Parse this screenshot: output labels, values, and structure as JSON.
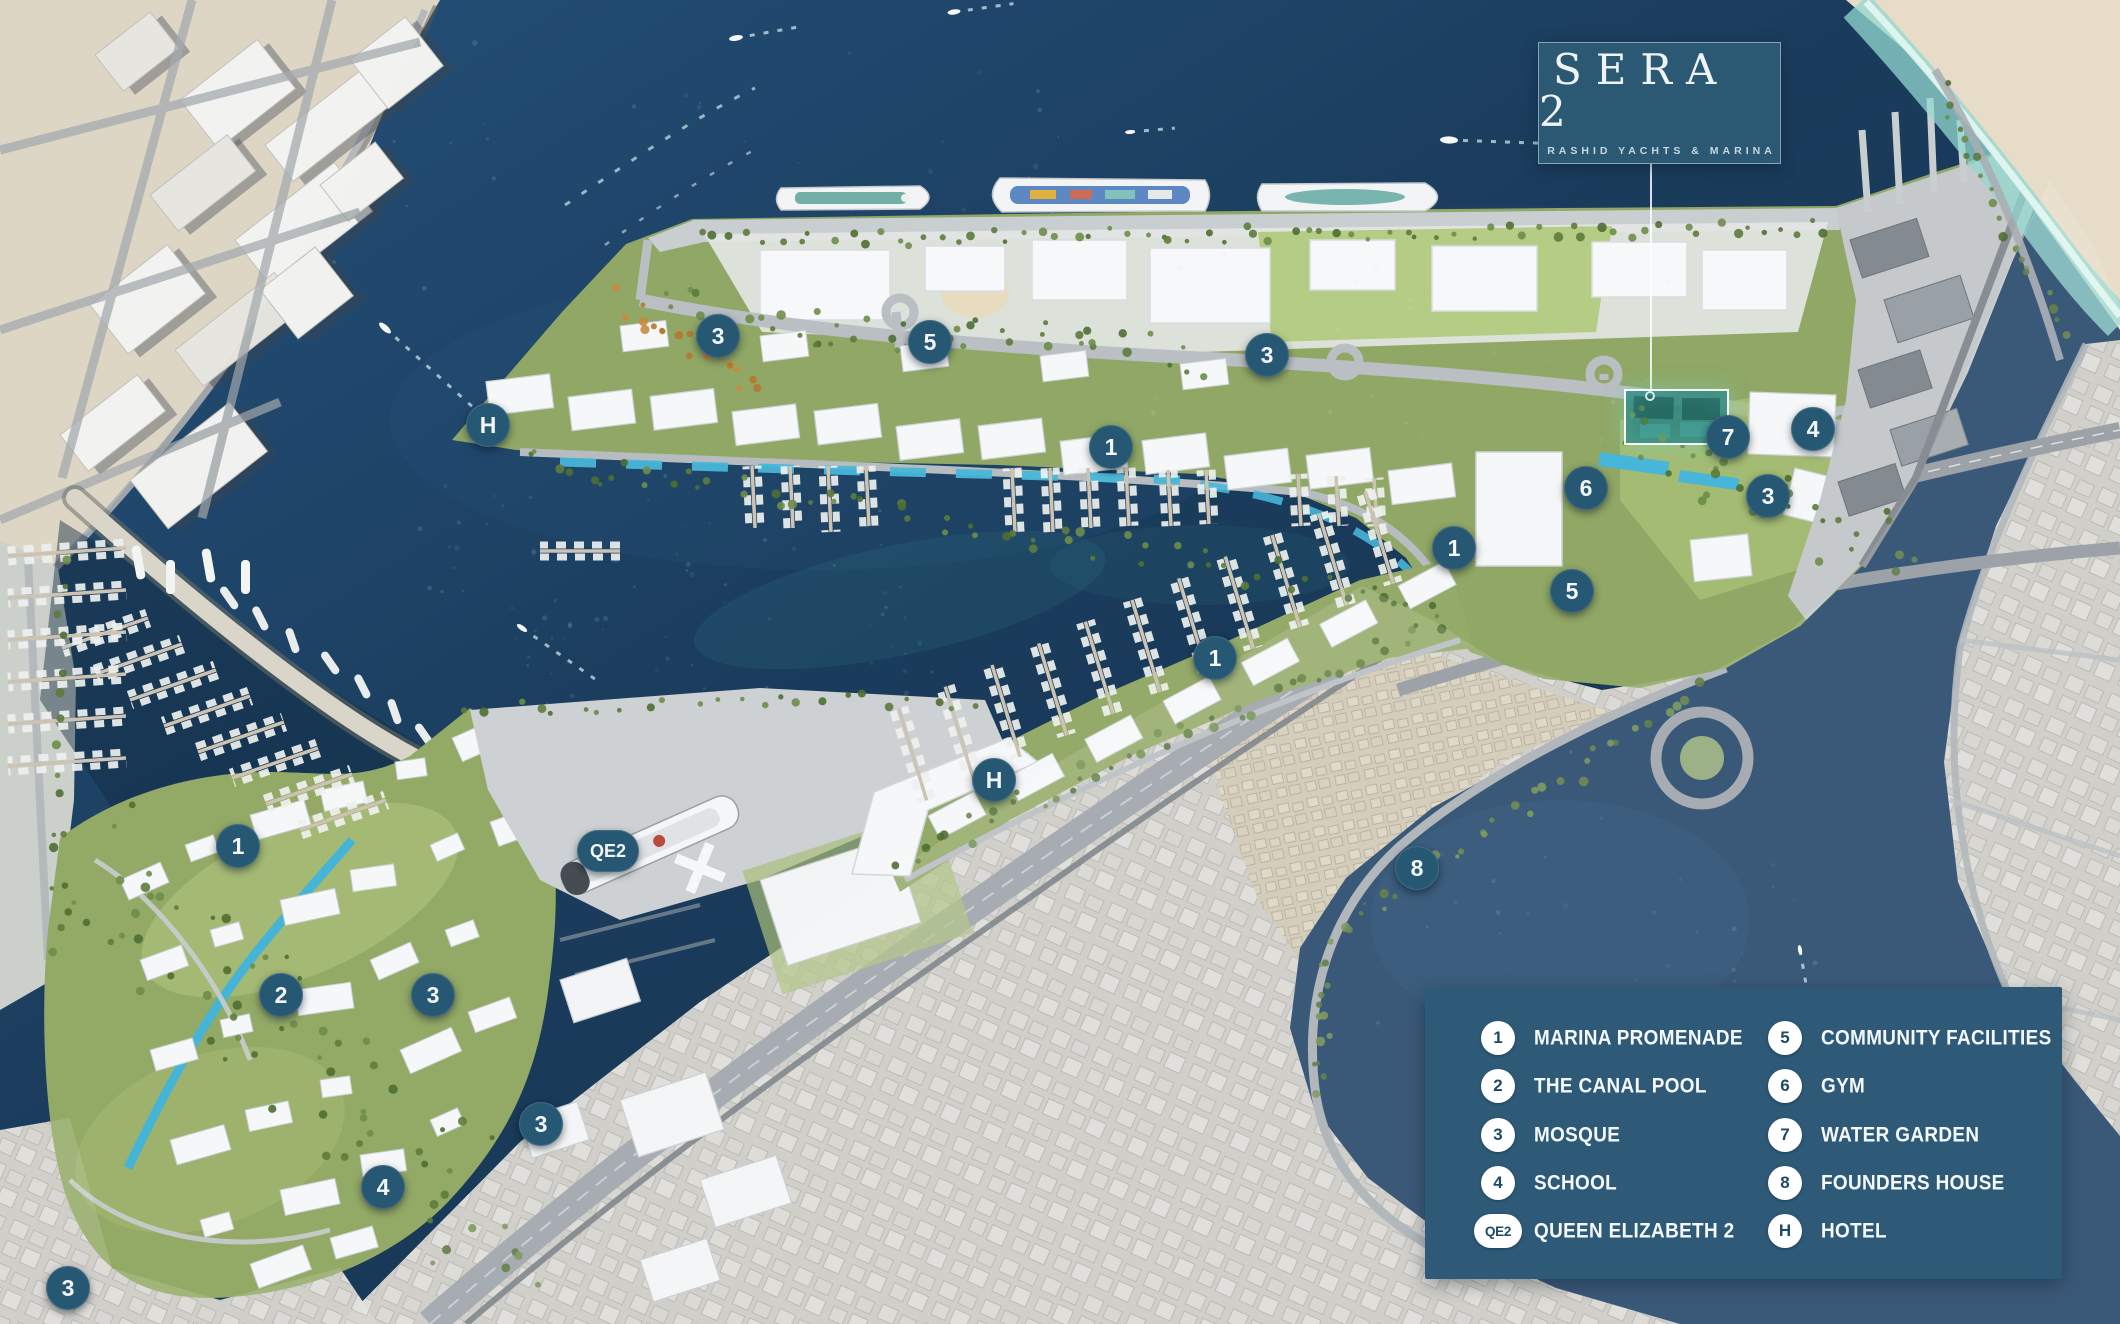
{
  "logo": {
    "title": "SERA 2",
    "subtitle": "RASHID YACHTS & MARINA"
  },
  "site_highlight": {
    "x": 1624,
    "y": 389,
    "w": 105,
    "h": 56
  },
  "legend": {
    "items": [
      {
        "id": "1",
        "label": "MARINA PROMENADE"
      },
      {
        "id": "2",
        "label": "THE CANAL POOL"
      },
      {
        "id": "3",
        "label": "MOSQUE"
      },
      {
        "id": "4",
        "label": "SCHOOL"
      },
      {
        "id": "QE2",
        "label": "QUEEN ELIZABETH 2"
      },
      {
        "id": "5",
        "label": "COMMUNITY FACILITIES"
      },
      {
        "id": "6",
        "label": "GYM"
      },
      {
        "id": "7",
        "label": "WATER GARDEN"
      },
      {
        "id": "8",
        "label": "FOUNDERS HOUSE"
      },
      {
        "id": "H",
        "label": "HOTEL"
      }
    ]
  },
  "markers": [
    {
      "label": "3",
      "name": "mosque",
      "x": 718,
      "y": 336
    },
    {
      "label": "5",
      "name": "community-facilities",
      "x": 930,
      "y": 342
    },
    {
      "label": "3",
      "name": "mosque",
      "x": 1267,
      "y": 355
    },
    {
      "label": "H",
      "name": "hotel",
      "x": 488,
      "y": 425
    },
    {
      "label": "1",
      "name": "marina-promenade",
      "x": 1111,
      "y": 447
    },
    {
      "label": "7",
      "name": "water-garden",
      "x": 1728,
      "y": 437
    },
    {
      "label": "4",
      "name": "school",
      "x": 1813,
      "y": 429
    },
    {
      "label": "6",
      "name": "gym",
      "x": 1586,
      "y": 488
    },
    {
      "label": "3",
      "name": "mosque",
      "x": 1768,
      "y": 496
    },
    {
      "label": "1",
      "name": "marina-promenade",
      "x": 1454,
      "y": 548
    },
    {
      "label": "5",
      "name": "community-facilities",
      "x": 1572,
      "y": 591
    },
    {
      "label": "1",
      "name": "marina-promenade",
      "x": 1215,
      "y": 658
    },
    {
      "label": "H",
      "name": "hotel",
      "x": 994,
      "y": 780
    },
    {
      "label": "8",
      "name": "founders-house",
      "x": 1417,
      "y": 868
    },
    {
      "label": "1",
      "name": "marina-promenade",
      "x": 238,
      "y": 846
    },
    {
      "label": "QE2",
      "name": "queen-elizabeth-2",
      "x": 608,
      "y": 851,
      "pill": true
    },
    {
      "label": "2",
      "name": "the-canal-pool",
      "x": 281,
      "y": 995
    },
    {
      "label": "3",
      "name": "mosque",
      "x": 433,
      "y": 995
    },
    {
      "label": "3",
      "name": "mosque",
      "x": 541,
      "y": 1124
    },
    {
      "label": "4",
      "name": "school",
      "x": 383,
      "y": 1187
    },
    {
      "label": "3",
      "name": "mosque",
      "x": 68,
      "y": 1288
    }
  ],
  "colors": {
    "panel": "#2e5a78",
    "card": "#2b5873",
    "marker": "#275873",
    "badge_text": "#1f4a66",
    "text": "#f2f6f8",
    "highlight": "#7fe3d4"
  }
}
